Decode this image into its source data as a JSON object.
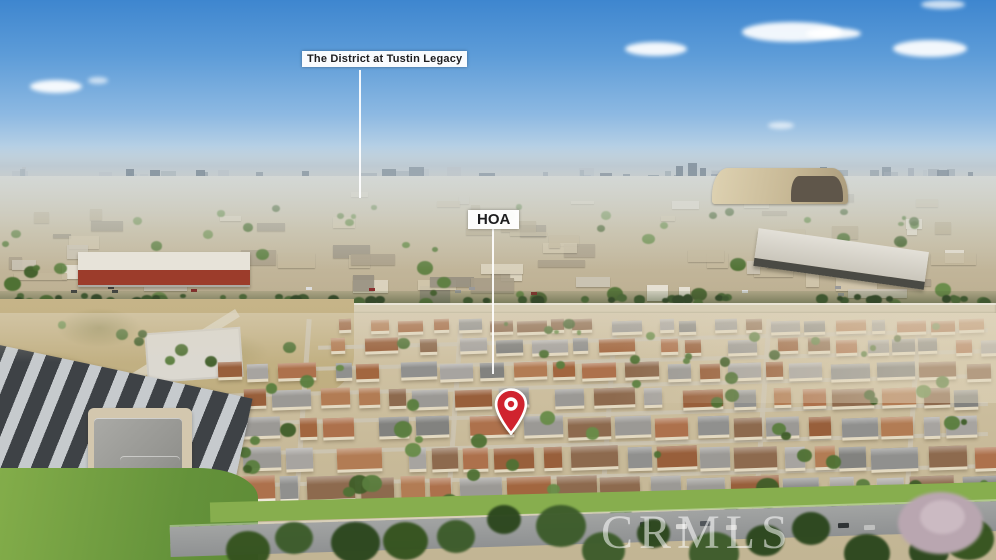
{
  "scene": {
    "description": "Aerial drone photo of a beige townhome HOA community in the foreground with an industrial and commercial district behind it, a large blimp hangar at right, hazy city skyline and blue sky with scattered clouds",
    "palette": {
      "sky_top": "#3e86cf",
      "sky_mid": "#7fb0e0",
      "sky_horizon": "#d7e2e9",
      "haze": "#ccd5da",
      "pin_red": "#d0232e",
      "label_bg": "#ffffff",
      "label_text": "#1d1d1f",
      "watermark_color": "rgba(255,255,255,0.55)",
      "street_gray": "#cdc6b4",
      "wall_beige": "#e3d9c1",
      "wall_white": "#efe9da",
      "roof_grays": [
        "#90908e",
        "#9b9995",
        "#82827f",
        "#a7a4a0"
      ],
      "roof_terracottas": [
        "#ad714c",
        "#a2663f",
        "#b27c54",
        "#985f3b",
        "#8d6a4e"
      ],
      "tree_greens": [
        "#4f7134",
        "#405e29",
        "#5a7e3e",
        "#688c48"
      ],
      "deep_greens": [
        "#35531f",
        "#2c471e",
        "#3d5c2b"
      ],
      "hedge_greens": [
        "#3f5730",
        "#35492a",
        "#4c6638"
      ],
      "mid_building_colors": [
        "#e9e4d8",
        "#ded6c2",
        "#d2c7ad",
        "#c4b89c",
        "#ccc5b6",
        "#b4a88c",
        "#a89d88",
        "#979081"
      ],
      "skyline_colors": [
        "#a9b4bc",
        "#9aa6af",
        "#bcc5cb",
        "#8b98a3"
      ],
      "car_colors": [
        "#3c4043",
        "#d8d8d6",
        "#50555a",
        "#c9c9c7",
        "#2f3335",
        "#bfc0bf"
      ]
    }
  },
  "annotations": {
    "district_label": "The District at Tustin Legacy",
    "hoa_label": "HOA"
  },
  "watermark": {
    "text": "CRMLS"
  }
}
